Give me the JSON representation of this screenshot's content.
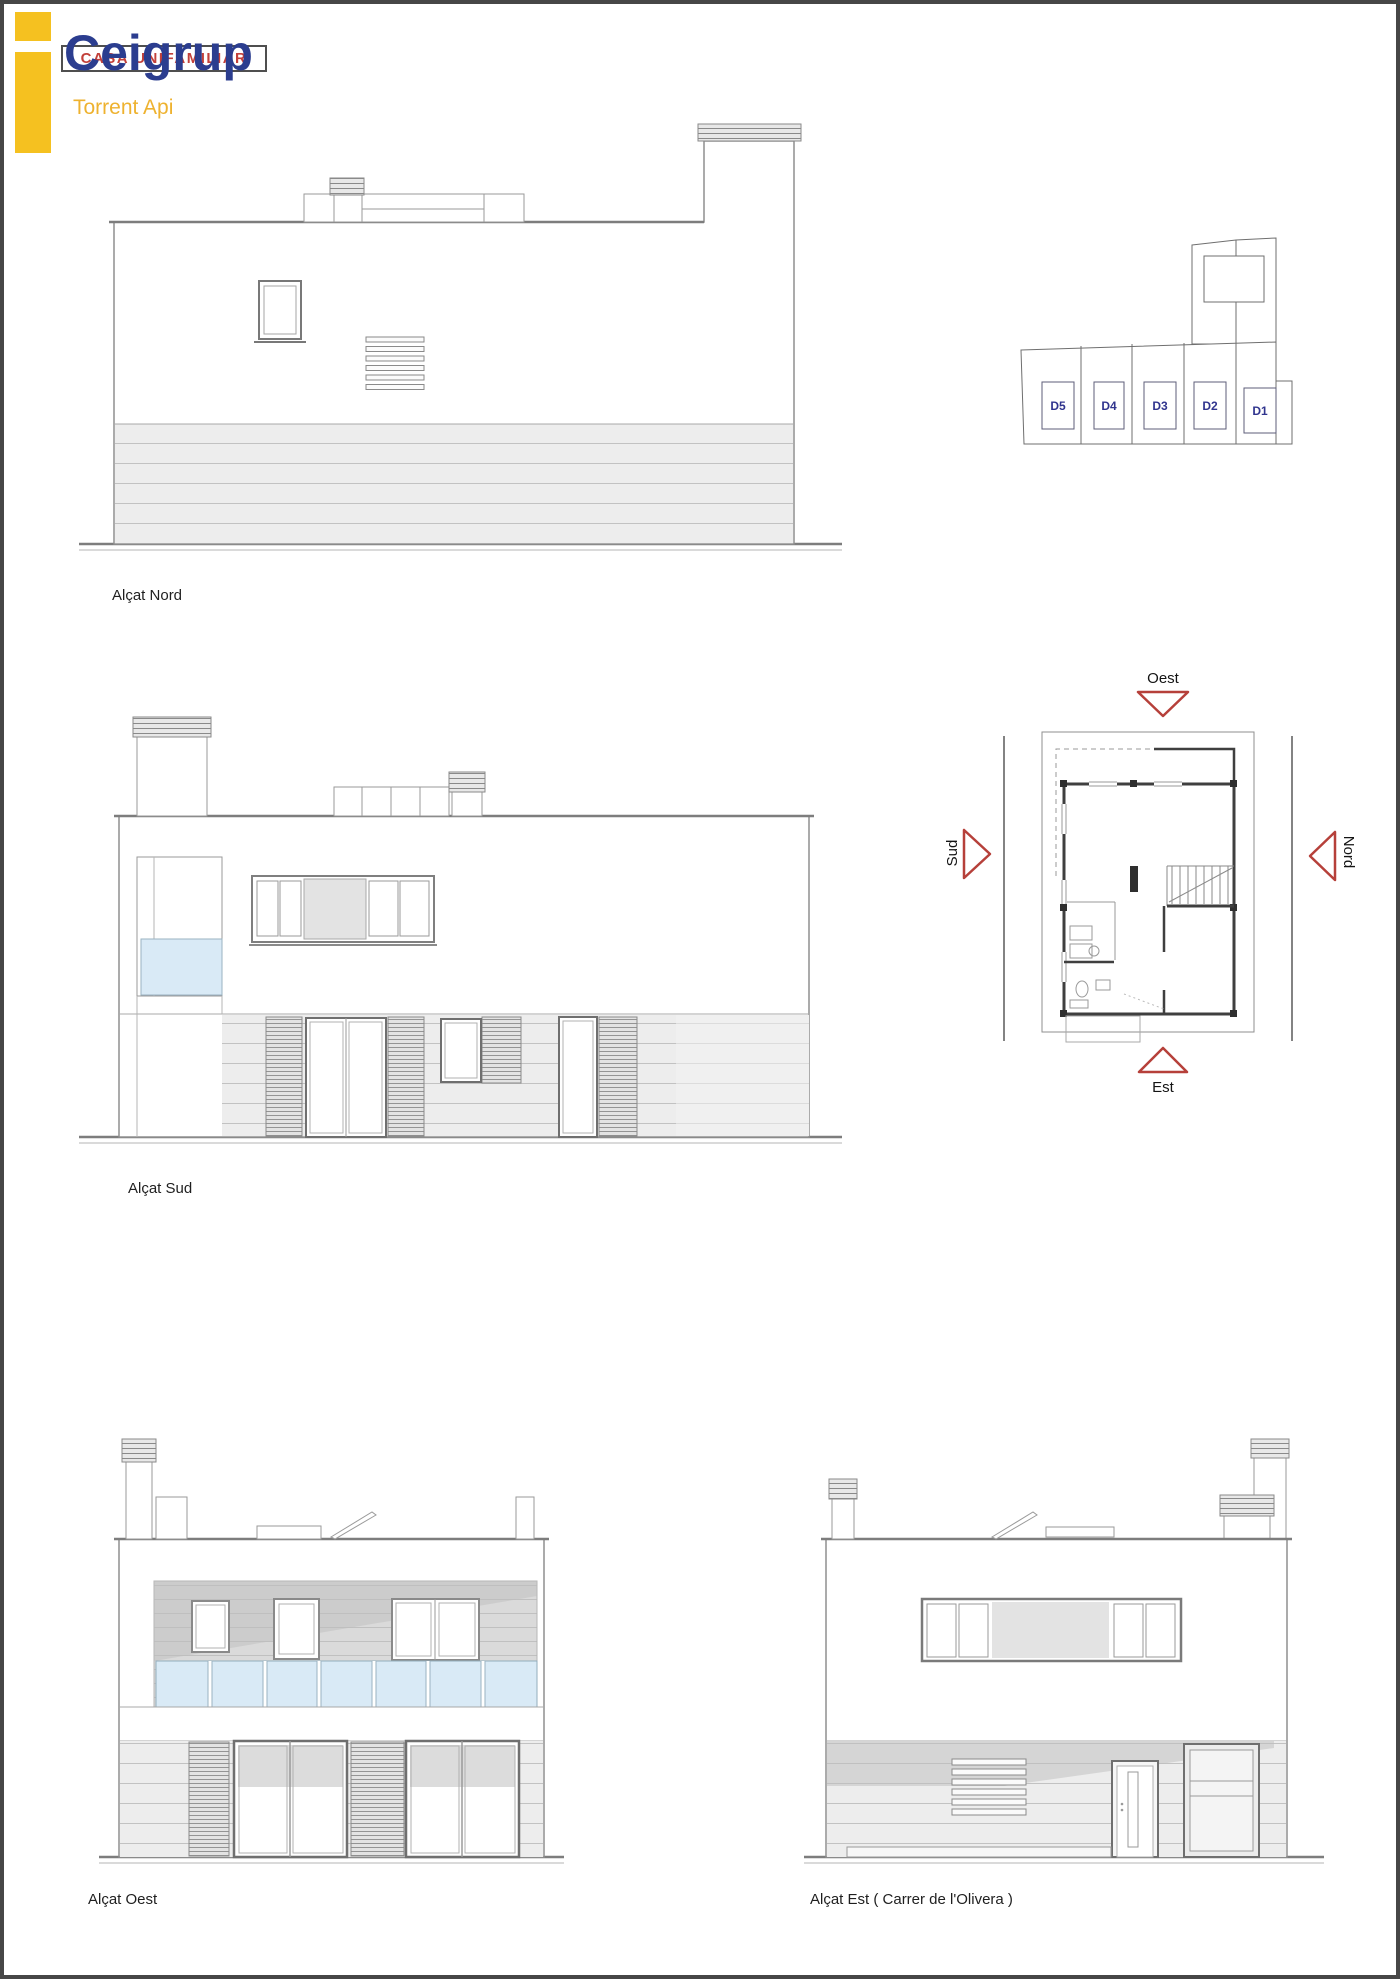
{
  "header": {
    "brand": "Ceigrup",
    "brand_sub": "Torrent Api",
    "project_label": "CASA UNIFAMILIAR",
    "brand_color": "#2b3d8f",
    "accent_yellow": "#f5c120",
    "project_text_color": "#c2403a"
  },
  "elevations": {
    "nord": {
      "label": "Alçat Nord"
    },
    "sud": {
      "label": "Alçat Sud"
    },
    "oest": {
      "label": "Alçat Oest"
    },
    "est": {
      "label": "Alçat Est ( Carrer de l'Olivera )"
    }
  },
  "site_plan": {
    "plots": [
      {
        "label": "D5"
      },
      {
        "label": "D4"
      },
      {
        "label": "D3"
      },
      {
        "label": "D2"
      },
      {
        "label": "D1"
      }
    ]
  },
  "floor_plan": {
    "orientation": {
      "top": "Oest",
      "left": "Sud",
      "right": "Nord",
      "bottom": "Est"
    },
    "arrow_color": "#b6403a"
  },
  "colors": {
    "line_gray": "#8f8f8f",
    "glass_blue": "#d9eaf6",
    "band_gray": "#ededed"
  }
}
